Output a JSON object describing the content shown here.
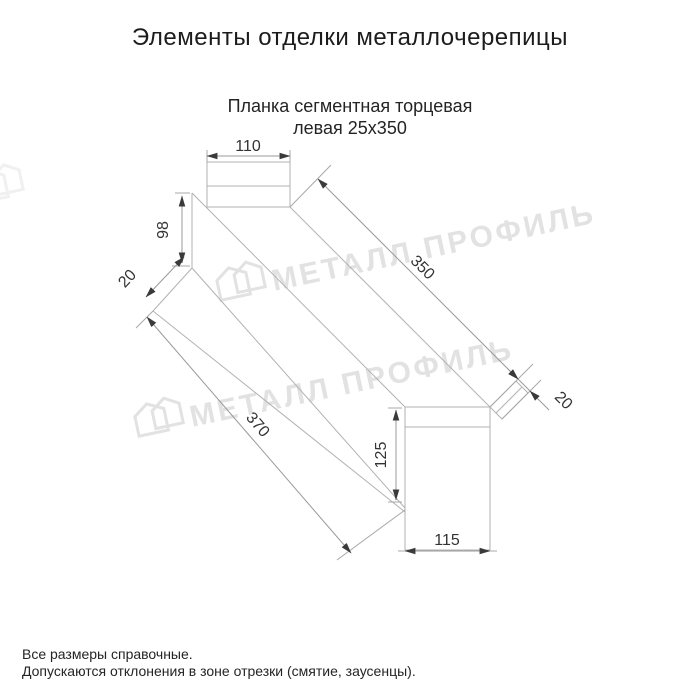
{
  "page": {
    "title": "Элементы отделки металлочерепицы"
  },
  "product": {
    "subtitle_line1": "Планка сегментная торцевая",
    "subtitle_line2": "левая 25x350"
  },
  "diagram": {
    "type": "technical-drawing",
    "dims": {
      "top_width": "110",
      "left_height": "98",
      "left_hem": "20",
      "length_top": "350",
      "end_tab": "20",
      "length_bottom": "370",
      "end_height": "125",
      "end_width": "115"
    },
    "colors": {
      "drawing_line": "#b2b2b2",
      "dimension_line": "#9a9a9a",
      "dimension_text": "#333333"
    }
  },
  "watermark": {
    "text": "МЕТАЛЛ ПРОФИЛЬ",
    "color": "#e2e2e2"
  },
  "footer": {
    "note1": "Все размеры справочные.",
    "note2": "Допускаются отклонения в зоне отрезки (смятие, заусенцы)."
  }
}
